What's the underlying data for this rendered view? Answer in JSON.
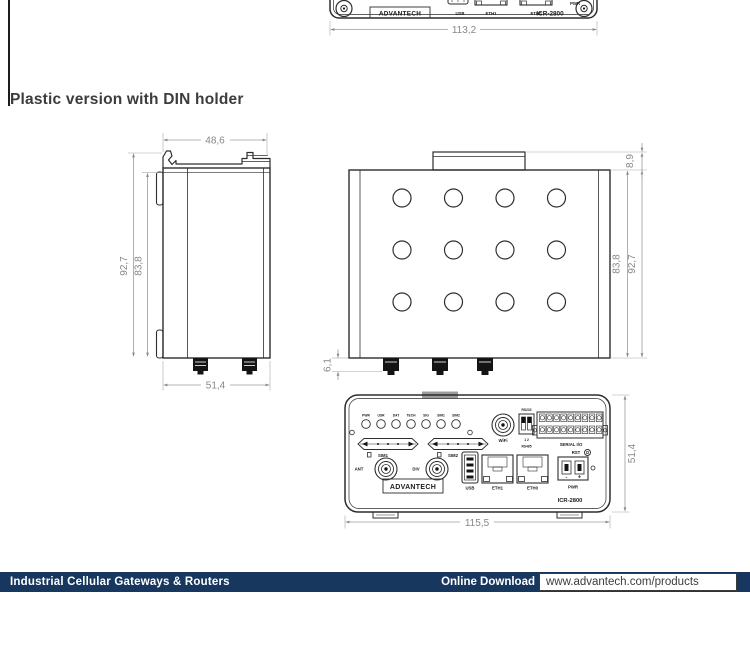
{
  "page": {
    "section_title": "Plastic version with DIN holder"
  },
  "colors": {
    "footer_bar": "#17375E",
    "dimension": "#878787",
    "drawing_line": "#2d2d2d"
  },
  "top_drawing": {
    "logo": "ADVANTECH",
    "model": "ICR-2800",
    "usb": "USB",
    "eth1": "ETH1",
    "eth0": "ETH0",
    "pwr": "PWR",
    "dim_width": "113,2"
  },
  "side_view": {
    "dims": {
      "top_width": "48,6",
      "outer_height": "92,7",
      "inner_height": "83,8",
      "bottom_width": "51,4"
    }
  },
  "top_view": {
    "dims": {
      "din_depth": "8,9",
      "inner_height": "83,8",
      "outer_height": "92,7",
      "connector_depth": "6,1"
    }
  },
  "front_panel": {
    "led_labels": [
      "PWR",
      "USR",
      "DAT",
      "TECH",
      "SIG",
      "SIM1",
      "SIM2"
    ],
    "sim1": "SIM1",
    "sim2": "SIM2",
    "ant": "ANT",
    "div": "DIV",
    "wifi": "WiFi",
    "rs232": "RS232",
    "dip_numbers": "1 2",
    "rs485": "RS485",
    "serial_io": "SERIAL I/O",
    "rst": "RST",
    "usb": "USB",
    "eth1": "ETH1",
    "eth0": "ETH0",
    "minus": "-",
    "plus": "+",
    "pwr": "PWR",
    "logo": "ADVANTECH",
    "model": "ICR-2800",
    "dim_width": "115,5",
    "dim_height": "51,4"
  },
  "footer": {
    "left_text": "Industrial Cellular Gateways & Routers",
    "download_label": "Online Download",
    "url": "www.advantech.com/products"
  }
}
